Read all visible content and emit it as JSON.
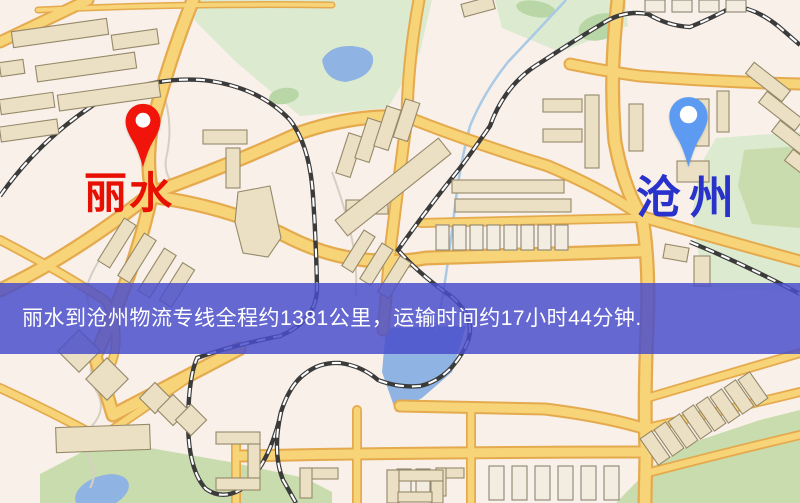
{
  "map": {
    "origin": {
      "label": "丽水",
      "pin_color": "#f0140a",
      "label_color": "#e81003"
    },
    "destination": {
      "label": "沧州",
      "pin_color": "#5d9bf3",
      "label_color": "#2a32cc"
    },
    "banner": {
      "text": "丽水到沧州物流专线全程约1381公里，运输时间约17小时44分钟.",
      "background_color": "#494dca",
      "text_color": "#ffffff"
    },
    "palette": {
      "background": "#f8f0e9",
      "road": "#f7d478",
      "road_casing": "#e5aa4e",
      "railway": "#3b3b3b",
      "water": "#8fb3e2",
      "park": "#dcead0",
      "building": "#ebdfc4"
    }
  }
}
